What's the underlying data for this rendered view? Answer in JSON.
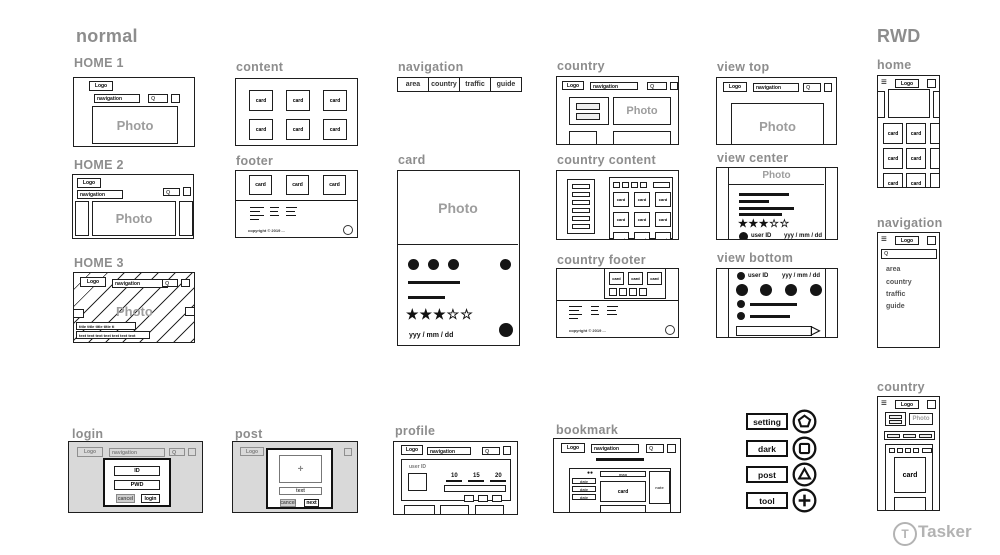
{
  "titles": {
    "normal": "normal",
    "rwd": "RWD"
  },
  "sections": {
    "home1": "HOME 1",
    "home2": "HOME 2",
    "home3": "HOME 3",
    "content": "content",
    "footer": "footer",
    "navigation": "navigation",
    "card": "card",
    "country": "country",
    "country_content": "country content",
    "country_footer": "country footer",
    "view_top": "view top",
    "view_center": "view center",
    "view_bottom": "view bottom",
    "login": "login",
    "post": "post",
    "profile": "profile",
    "bookmark": "bookmark",
    "rwd_home": "home",
    "rwd_navigation": "navigation",
    "rwd_country": "country"
  },
  "common": {
    "logo": "Logo",
    "navigation": "navigation",
    "search": "Q",
    "photo": "Photo",
    "card": "card",
    "date": "yyy / mm / dd",
    "user_id": "user ID",
    "stars": "★★★☆☆",
    "copyright": "copyright © 2019 ...",
    "hamburger": "≡",
    "send_arrow": "▷",
    "dots_pair": "●●",
    "plus": "+"
  },
  "nav_items": {
    "area": "area",
    "country": "country",
    "traffic": "traffic",
    "guide": "guide"
  },
  "home3": {
    "title_line": "title title title title ti",
    "text_line": "text text text text text text text"
  },
  "login_modal": {
    "id": "ID",
    "pwd": "PWD",
    "cancel": "cancel",
    "submit": "login"
  },
  "post_modal": {
    "text_field": "text",
    "cancel": "cancel",
    "next": "next"
  },
  "profile_stats": {
    "s1": "10",
    "s2": "15",
    "s3": "20"
  },
  "bookmark_parts": {
    "map": "map",
    "card": "card",
    "note": "note",
    "date": "date"
  },
  "action_buttons": {
    "setting": "setting",
    "dark": "dark",
    "post": "post",
    "tool": "tool"
  },
  "watermark": {
    "brand": "Tasker",
    "logo_letter": "T"
  }
}
